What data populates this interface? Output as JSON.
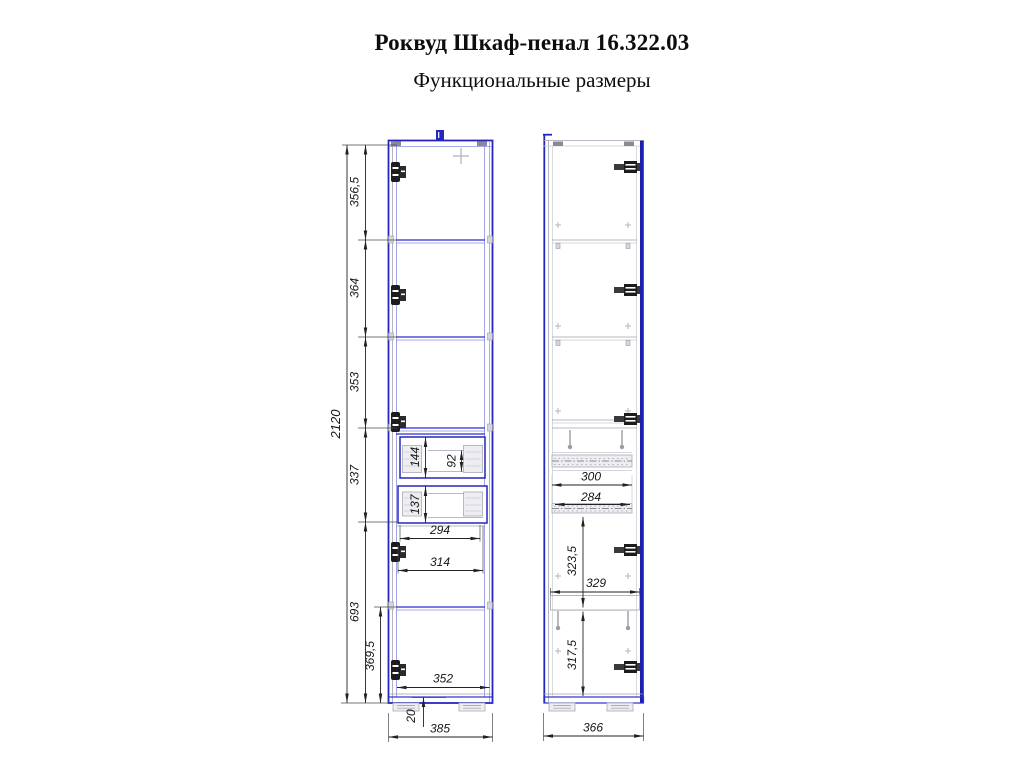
{
  "header": {
    "title": "Роквуд Шкаф-пенал 16.322.03",
    "subtitle": "Функциональные размеры"
  },
  "front_view": {
    "overall_height": "2120",
    "sections": [
      "356,5",
      "364",
      "353",
      "337",
      "693"
    ],
    "bottom_compartment_height": "369,5",
    "drawer_top_height": "144",
    "drawer_top_clear": "92",
    "drawer_bottom_height": "137",
    "drawer_inner_width": "294",
    "drawer_width": "314",
    "inner_width": "352",
    "bottom_panel": "20",
    "overall_width": "385"
  },
  "side_view": {
    "rail_length": "300",
    "rail_clear": "284",
    "niche_height": "323,5",
    "shelf_depth": "329",
    "bottom_niche_height": "317,5",
    "overall_depth": "366"
  },
  "colors": {
    "outline_blue": "#2526bd",
    "secondary_gray": "#a0a2ae",
    "dimension_black": "#1a1a1a"
  }
}
